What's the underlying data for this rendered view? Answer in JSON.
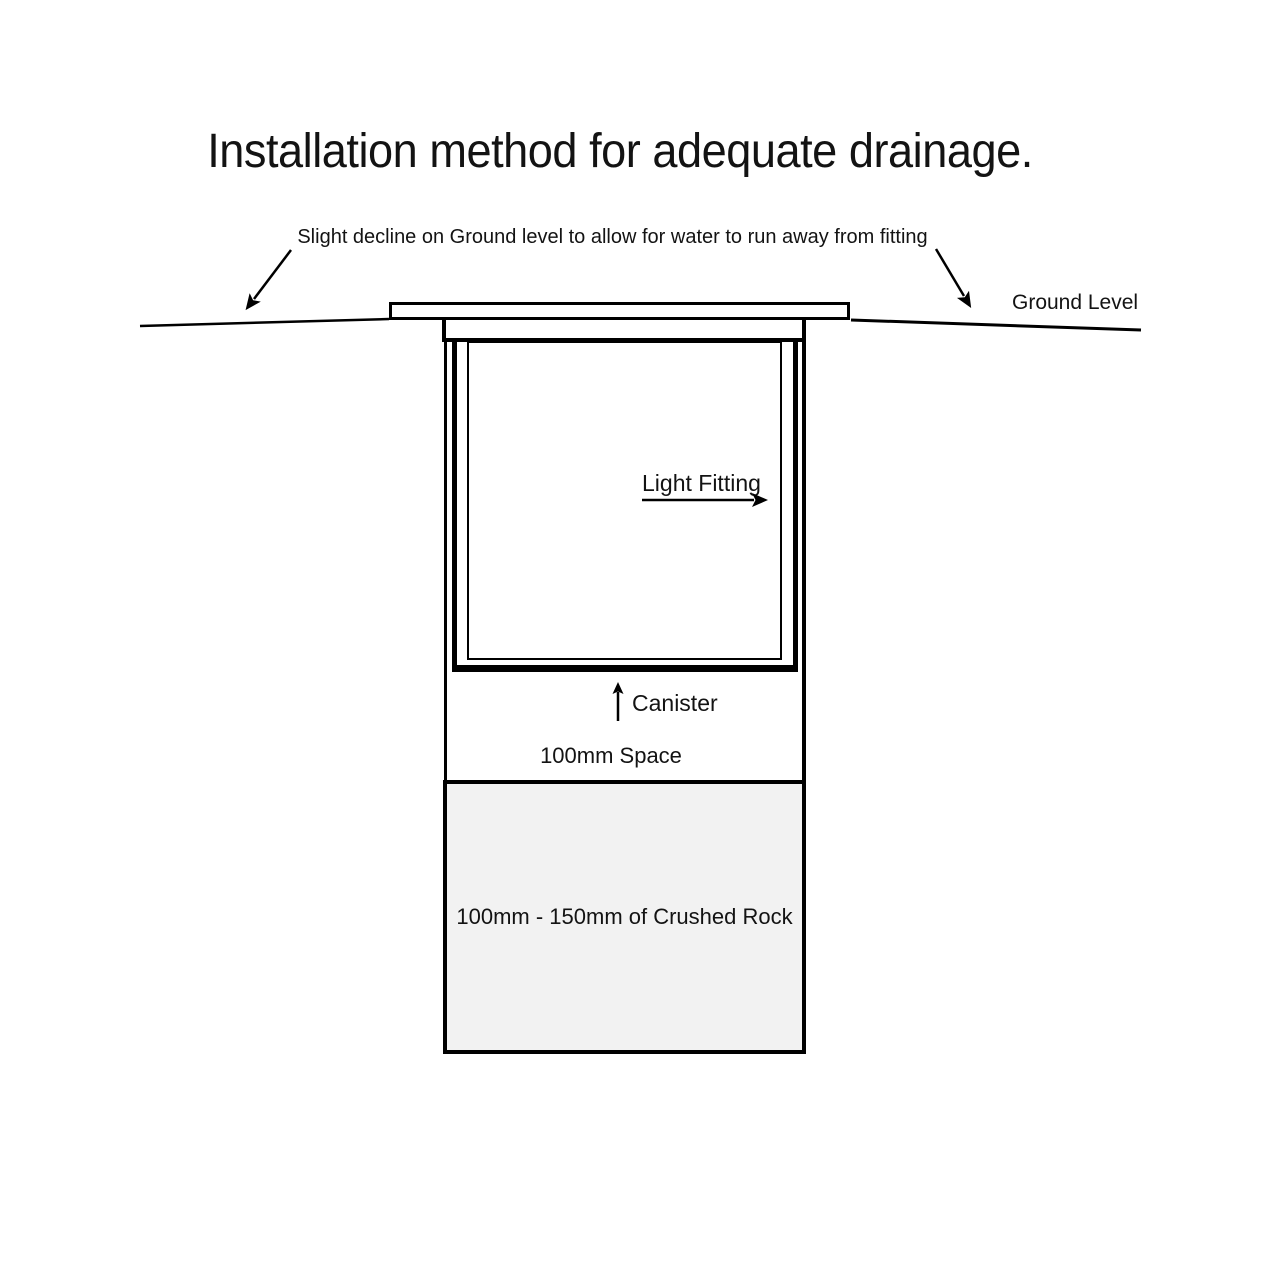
{
  "page": {
    "title": "Installation method for adequate drainage."
  },
  "annotation": {
    "text": "Slight decline on Ground level to allow for water to run away from fitting"
  },
  "labels": {
    "ground_level": "Ground Level",
    "light_fitting": "Light Fitting",
    "canister": "Canister",
    "space": "100mm Space",
    "crushed_rock": "100mm - 150mm of Crushed Rock"
  },
  "colors": {
    "line": "#000000",
    "text": "#131313",
    "background": "#ffffff",
    "crushed_rock_fill": "#f2f2f2"
  }
}
